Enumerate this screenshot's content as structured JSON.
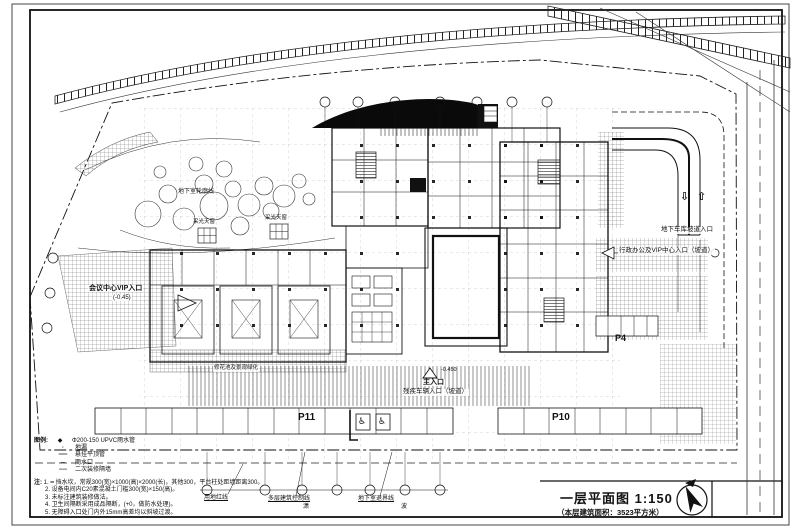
{
  "colors": {
    "ink": "#111111",
    "paper": "#ffffff",
    "canopy": "#0a0a0a"
  },
  "title_block": {
    "title": "一层平面图  1:150",
    "subtitle": "（本层建筑面积：3523平方米）"
  },
  "labels": {
    "basement_outline": "地下室轮廓线",
    "skylight": "采光天窗",
    "vip_entrance": "会议中心VIP入口",
    "vip_entrance_elev": "(-0.45)",
    "admin_entrance": "行政办公及VIP中心入口（坡道）",
    "garage_ramp_entrance": "地下车库坡道入口",
    "ramp_down_arrow": "⇩",
    "ramp_up_arrow": "⇧",
    "main_entrance": "主入口",
    "main_entrance_elev": "-0.450",
    "accessible_entrance": "残疾车辆入口（坡道）",
    "planter": "修花池及景观绿化",
    "p11": "P11",
    "p10": "P10",
    "p4": "P4",
    "wheelchair": "♿",
    "site_red_line": "用地红线",
    "control_line": "多层建筑控制线",
    "basement_setback_line": "地下室退界线",
    "char_left": "潇",
    "char_right": "波"
  },
  "legend": {
    "heading": "图例:",
    "items": [
      {
        "symbol": "◆",
        "text": "Φ200-150 UPVC雨水管"
      },
      {
        "symbol": "·",
        "text": "地漏"
      },
      {
        "symbol": "══",
        "text": "悬挂平顶管"
      },
      {
        "symbol": "─",
        "text": "雨水口"
      },
      {
        "symbol": "----",
        "text": "二次装修隔墙"
      }
    ]
  },
  "notes": {
    "heading": "注:",
    "items": [
      "1. ━ 挡水坎，常规300(宽)×1000(高)×2000(长)，其他300，平台柱处距墙距离300。",
      "2. 设备电间内C20素混凝土门槛300(宽)×150(高)。",
      "3. 未标注建筑装修做法。",
      "4. 卫生间隔断采用成品隔断，(+0，做防水处理)。",
      "5. 无障碍入口处门内外15mm高差均以斜坡过渡。"
    ]
  }
}
